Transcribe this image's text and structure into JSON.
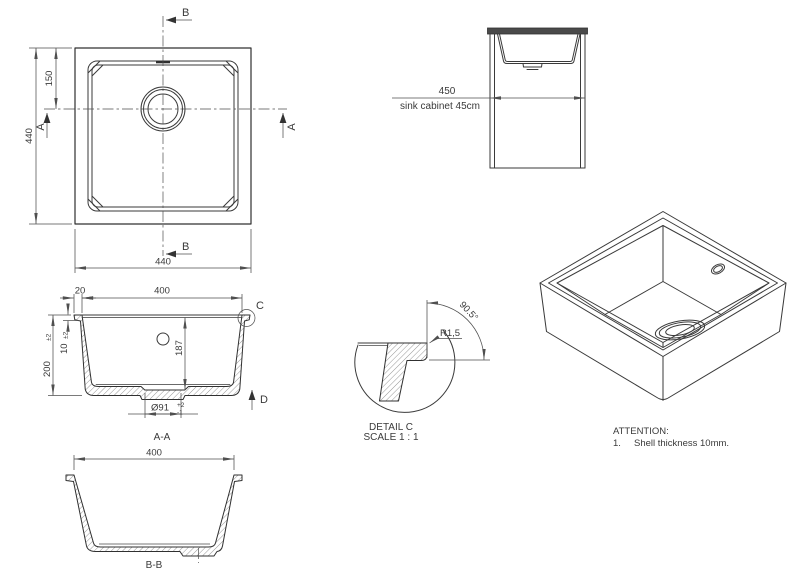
{
  "colors": {
    "background": "#ffffff",
    "geometry_line": "#3a3a3a",
    "dimension_line": "#4f4f4f",
    "text": "#3a3a3a",
    "countertop_fill": "#4a4a4a"
  },
  "top_view": {
    "section_b": "B",
    "section_a": "A",
    "dim_drain_offset": "150",
    "dim_height": "440",
    "dim_width": "440"
  },
  "cabinet_view": {
    "dim_width": "450",
    "caption": "sink cabinet 45cm"
  },
  "section_aa": {
    "label": "A-A",
    "dim_rim_width": "20",
    "dim_inner_width": "400",
    "dim_height": "200",
    "dim_height_tol": "±2",
    "dim_shell": "10",
    "dim_shell_tol": "±2",
    "dim_depth": "187",
    "dim_drain_dia": "Ø91",
    "dim_drain_tol_plus": "+2",
    "dim_drain_tol_minus": "-1",
    "detail_marker": "C",
    "view_marker": "D"
  },
  "detail_c": {
    "radius": "R1,5",
    "angle": "90.5°",
    "title": "DETAIL C",
    "scale": "SCALE 1 : 1"
  },
  "section_bb": {
    "label": "B-B",
    "dim_inner_width": "400"
  },
  "notes": {
    "heading": "ATTENTION:",
    "item_number": "1.",
    "item_text": "Shell thickness 10mm."
  }
}
